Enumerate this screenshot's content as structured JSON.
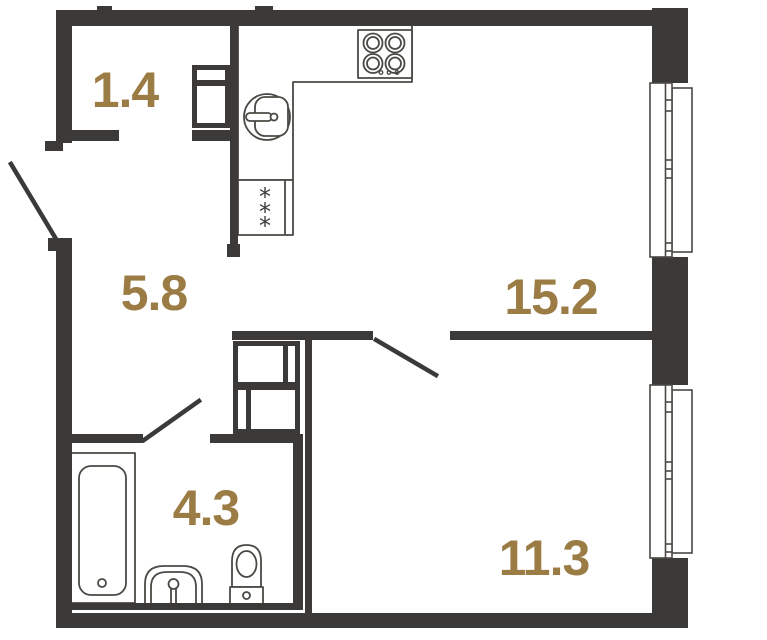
{
  "plan": {
    "background_color": "#ffffff",
    "wall_color": "#3b3a38",
    "line_color": "#4b4944",
    "label_color": "#9b7c44",
    "rooms": [
      {
        "id": "entry-hall",
        "area": "1.4"
      },
      {
        "id": "corridor",
        "area": "5.8"
      },
      {
        "id": "kitchen-living-room",
        "area": "15.2"
      },
      {
        "id": "bathroom",
        "area": "4.3"
      },
      {
        "id": "room",
        "area": "11.3"
      }
    ],
    "fridge_mark": "*",
    "icons": {
      "stove": "stove-icon",
      "kitchen_sink": "kitchen-sink-icon",
      "fridge": "fridge-icon",
      "wardrobe": "wardrobe-icon",
      "vent_shaft": "vent-shaft-icon",
      "bathtub": "bathtub-icon",
      "washbasin": "washbasin-icon",
      "toilet": "toilet-icon",
      "window": "window-icon",
      "door": "door-swing-icon"
    }
  }
}
